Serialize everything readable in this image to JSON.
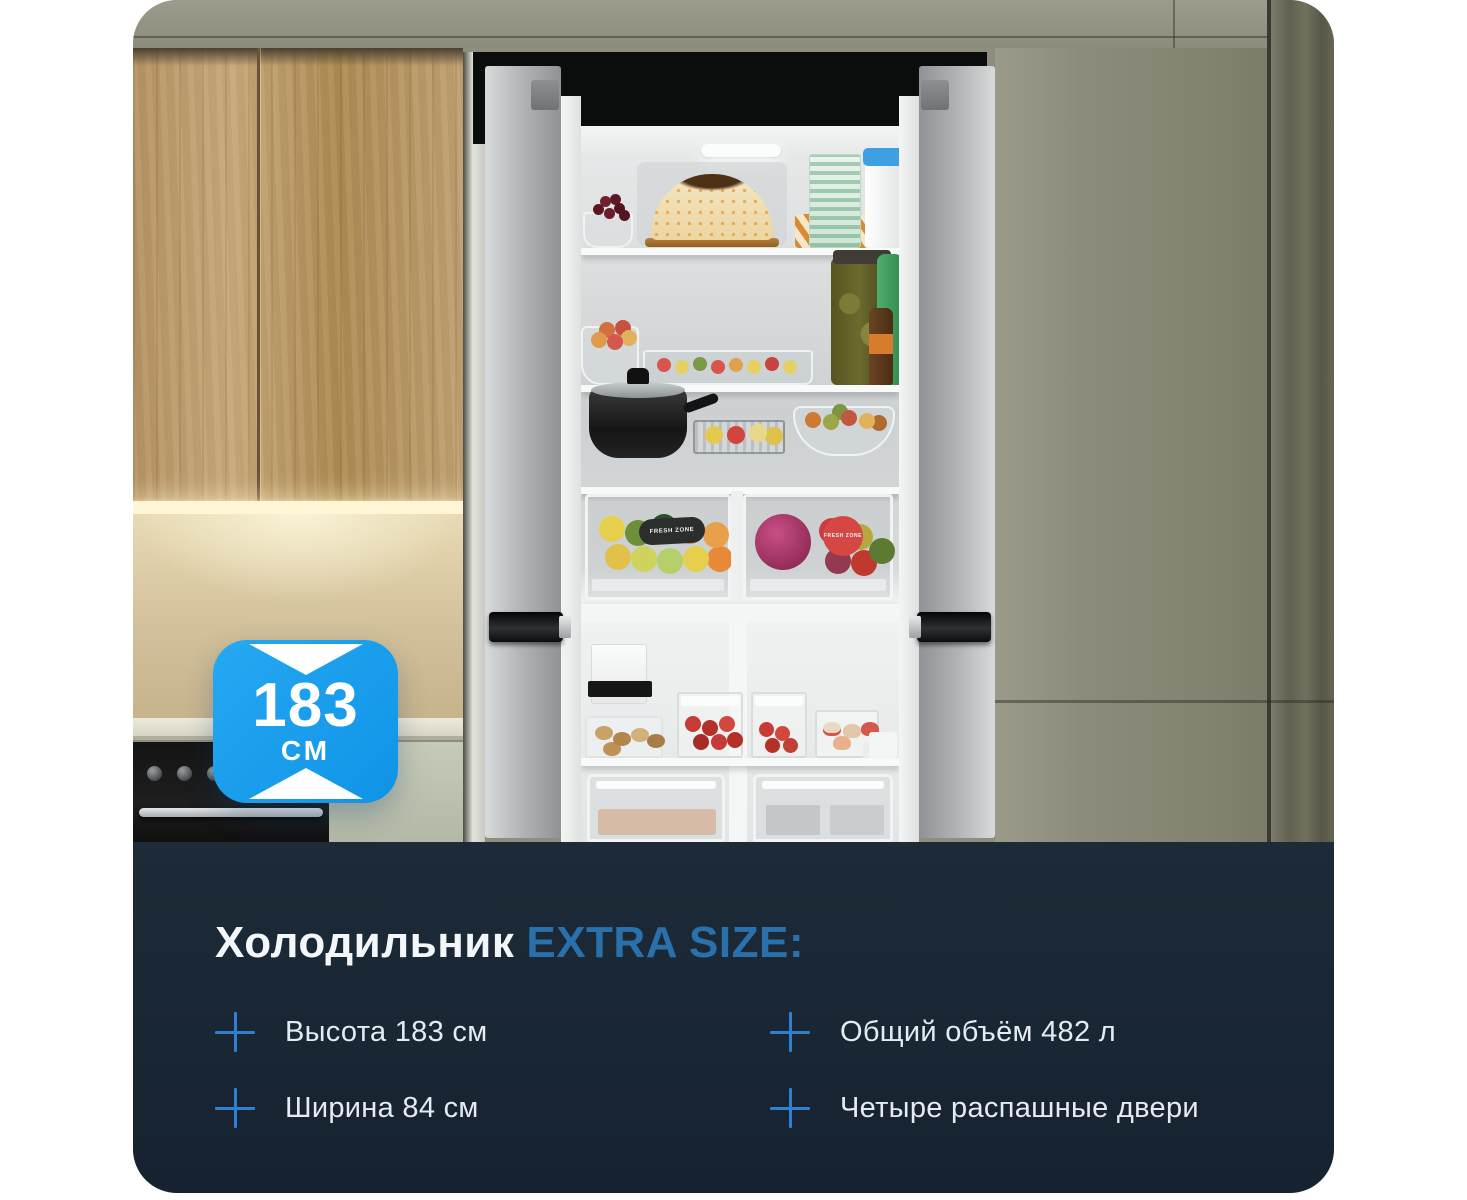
{
  "badge": {
    "value": "183",
    "unit": "СМ",
    "background": "#149bec",
    "icon": "height-arrows-icon"
  },
  "panel": {
    "background": "#1a2633",
    "title": {
      "regular": "Холодильник",
      "highlight": "EXTRA SIZE:",
      "highlight_color": "#2a71ab"
    },
    "bullet_icon": "plus-icon",
    "bullet_color": "#2f80d0",
    "features": [
      {
        "label": "Высота 183 см"
      },
      {
        "label": "Ширина 84 см"
      },
      {
        "label": "Общий объём 482 л"
      },
      {
        "label": "Четыре распашные двери"
      }
    ]
  },
  "photo": {
    "fresh_zone_label": "FRESH ZONE"
  }
}
